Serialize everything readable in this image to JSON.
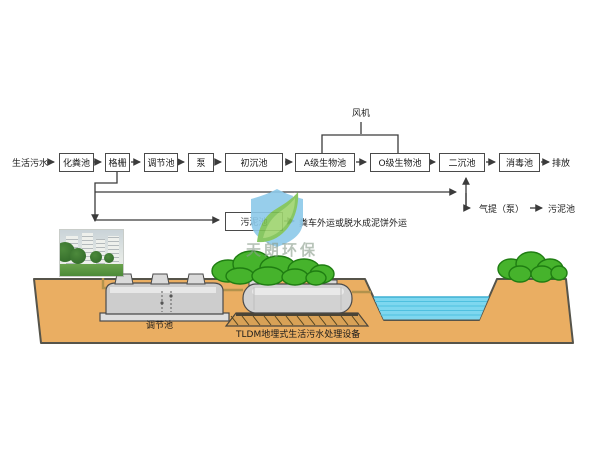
{
  "flow": {
    "source": "生活污水",
    "stages": [
      "化粪池",
      "格栅",
      "调节池",
      "泵",
      "初沉池",
      "A级生物池",
      "O级生物池",
      "二沉池",
      "消毒池"
    ],
    "discharge": "排放",
    "blower": "风机",
    "sludge_tank": "污泥池",
    "sludge_disposal": "粪车外运或脱水成泥饼外运",
    "airlift": "气提（泵）",
    "airlift_target": "污泥池"
  },
  "scene": {
    "tank1_label": "调节池",
    "tank2_label": "TLDM地埋式生活污水处理设备"
  },
  "watermark": {
    "brand": "天朗环保"
  },
  "colors": {
    "ground": "#EAAE62",
    "water": "#7ED7EF",
    "bush": "#46B32C",
    "tank": "#D2D2D2",
    "logo_blue": "#8CC9E9",
    "logo_green": "#7CC253",
    "line": "#3B3B3B"
  }
}
